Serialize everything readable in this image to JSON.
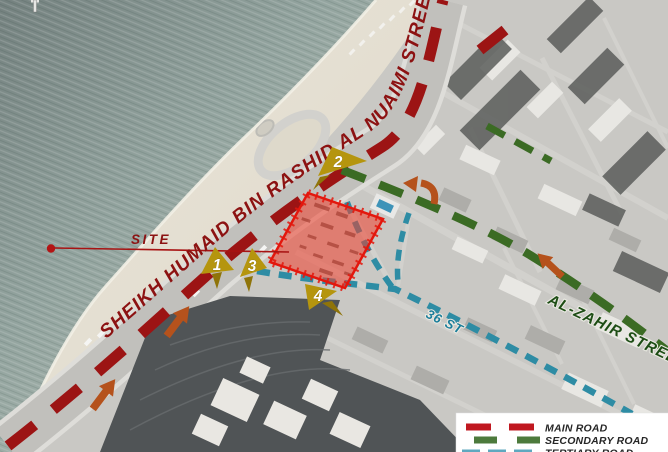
{
  "map": {
    "site": {
      "label": "SITE"
    },
    "streets": {
      "main": {
        "name": "SHEIKH HUMAID BIN RASHID AL NUAIMI STREET",
        "map_color": "#9c1414",
        "label_color": "#8c1212"
      },
      "secondary": {
        "name": "AL-ZAHIR STREET",
        "map_color": "#3b6b24",
        "label_color": "#1d4d15"
      },
      "tertiary": {
        "name": "36 ST",
        "map_color": "#2e8ca4",
        "label_color": "#1b7e9b"
      }
    },
    "markers": [
      {
        "label": "1"
      },
      {
        "label": "2"
      },
      {
        "label": "3"
      },
      {
        "label": "4"
      }
    ],
    "marker_color": "#b5950e",
    "arrow_color": "#b5521c",
    "site_fill": "#f0402d",
    "site_border": "#e3170d"
  },
  "legend": {
    "items": [
      {
        "label": "MAIN ROAD",
        "color": "#c01820"
      },
      {
        "label": "SECONDARY ROAD",
        "color": "#4d7a3c"
      },
      {
        "label": "TERTIARY ROAD",
        "color": "#5fa8bf"
      }
    ]
  }
}
